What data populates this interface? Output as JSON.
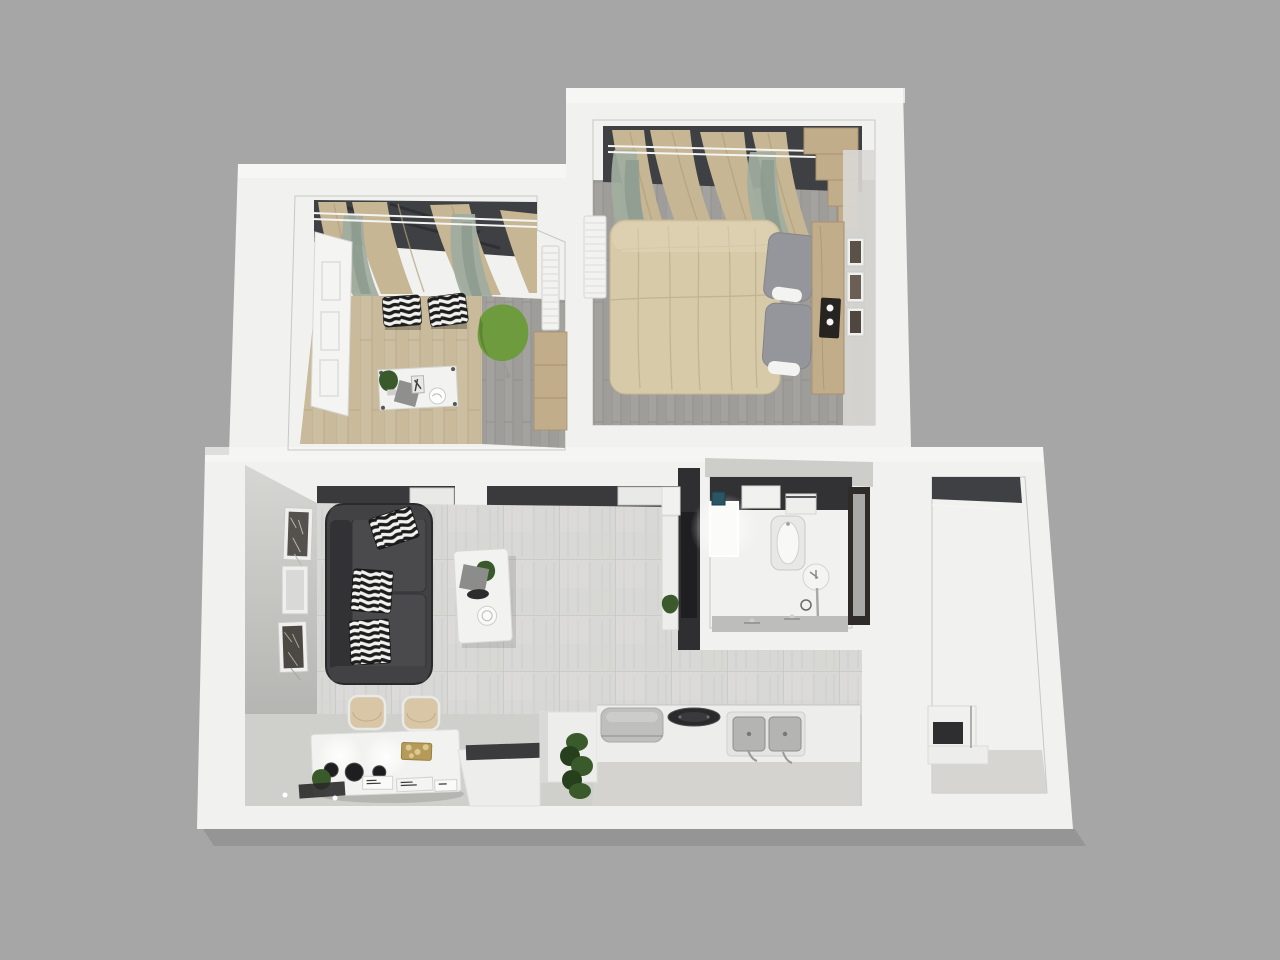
{
  "scene": {
    "description": "3D rendered top-down floor plan of a one-bedroom apartment",
    "view": "top-down-3d-render",
    "visible_text": "none"
  },
  "palette": {
    "background": "#a6a6a6",
    "wall_white": "#f1f1ef",
    "wall_bright": "#f7f7f5",
    "wall_face": "#e3e3e1",
    "wall_face_dark": "#cfcfcc",
    "tile_floor": "#d8d8d6",
    "tile_grout": "#c7c7c5",
    "tile_streak": "#c3c3c1",
    "smooth_floor": "#cfcfcb",
    "kitchen_floor": "#d4d3cf",
    "wood_floor": "#ccbfa1",
    "wood_line": "#b5a685",
    "gray_plank": "#a4a29f",
    "gray_plank_line": "#908e8b",
    "dark_recess": "#3a3a3d",
    "accent_wall": "#2f2f32",
    "tv_black": "#1f1f21",
    "window_dark": "#3e4043",
    "rod_white": "#f4f4f2",
    "curtain_drape": "#c6b693",
    "curtain_drape_dark": "#b0a07c",
    "curtain_sheer": "#a0ad9f",
    "curtain_sheer_dark": "#8b9a8d",
    "sofa_body": "#424245",
    "sofa_dark": "#2f2f32",
    "sofa_seat": "#4a4a4d",
    "zebra_black": "#1d1d1d",
    "zebra_white": "#f1f1ef",
    "bed_duvet": "#d7caa9",
    "bed_crease": "#c1b28e",
    "pillow_gray": "#94969b",
    "pillow_white": "#f3f3f1",
    "wood_furniture": "#c2ad8a",
    "wood_furniture_dark": "#a8916d",
    "green_chair": "#6e9b3d",
    "green_chair_dark": "#597f2e",
    "plant_green": "#3a5a2b",
    "plant_dark": "#263f1c",
    "counter_white": "#ededeb",
    "appliance_gray": "#bfbfbd",
    "dark_counter": "#3b3b3d",
    "steel": "#b4b4b2",
    "steel_dark": "#8e8e8c",
    "bathroom_tile": "#2b2b2d",
    "bathroom_grout": "#515154",
    "door_dark": "#2e2b28",
    "door_glass": "#b7b7b5",
    "teal_item": "#2a5564",
    "frame_white": "#efefed",
    "table_white": "#f2f2f0",
    "gold": "#b69a58",
    "chair_beige": "#d8c6a6"
  },
  "rooms": [
    {
      "name": "study",
      "floor": "light-oak-planks",
      "items": [
        "white-open-door",
        "window-with-curtains",
        "zebra-print-cushions",
        "green-swivel-chair",
        "white-desk",
        "potted-plant",
        "radiator",
        "wooden-cabinet"
      ]
    },
    {
      "name": "bedroom",
      "floor": "gray-planks",
      "items": [
        "double-bed-beige-duvet",
        "gray-pillows",
        "wooden-headboard",
        "stepped-wardrobe",
        "candle-tray",
        "three-wall-frames",
        "radiator",
        "window-with-curtains"
      ]
    },
    {
      "name": "living-room",
      "floor": "light-gray-tiles",
      "items": [
        "charcoal-corner-sofa",
        "zebra-print-pillows",
        "white-coffee-table",
        "dark-tv-accent-wall",
        "white-media-console",
        "three-wall-frames",
        "white-dining-table",
        "two-beige-chairs",
        "pendant-light-glow",
        "black-bowls",
        "gold-tray",
        "doormat"
      ]
    },
    {
      "name": "kitchen",
      "floor": "light-gray-tiles",
      "items": [
        "white-peninsula",
        "gray-appliance",
        "round-black-cooktop",
        "double-stainless-sink",
        "chrome-faucets",
        "dark-counter-inset",
        "tall-green-plant"
      ]
    },
    {
      "name": "bathroom",
      "floor": "dark-mosaic-tiles",
      "items": [
        "lit-shower-tray",
        "washing-machine",
        "white-shelf",
        "teal-box",
        "bathtub",
        "round-basin",
        "chrome-faucet-stem",
        "vanity-counter",
        "frosted-glass-door"
      ]
    },
    {
      "name": "utility-balcony",
      "floor": "warm-gray",
      "items": [
        "dark-window",
        "white-counter",
        "microwave"
      ]
    }
  ]
}
